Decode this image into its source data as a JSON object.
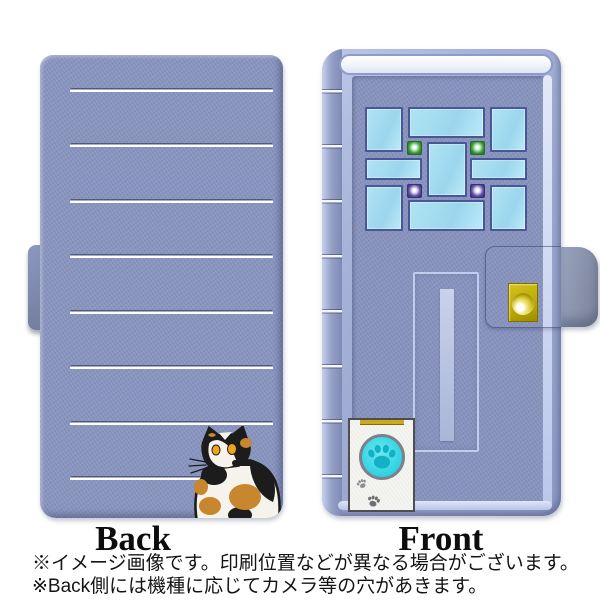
{
  "labels": {
    "back": "Back",
    "front": "Front"
  },
  "footnotes": {
    "line1": "※イメージ画像です。印刷位置などが異なる場合がございます。",
    "line2": "※Back側には機種に応じてカメラ等の穴があきます。"
  },
  "icons": {
    "cat": "calico-cat-illustration",
    "paw_button": "paw-print-button",
    "paw_marks": "paw-prints-decoration",
    "snap": "gold-snap-button"
  },
  "colors": {
    "case_fabric": "#8793bd",
    "case_rim_highlight": "#c6d1ee",
    "stripe_white": "#ffffff",
    "window_pane": "#a8dff2",
    "window_frame": "#4a5797",
    "led_green": "#3c9a3c",
    "led_purple": "#5d4f9e",
    "snap_gold": "#c6b40a",
    "pet_door_white": "#f4f4f1",
    "paw_cyan": "#2fd2e2",
    "paw_print_teal": "#12b1c5",
    "cat_black": "#1c1c1c",
    "cat_white": "#f6f3ec",
    "cat_orange": "#c8862f",
    "text": "#141414"
  }
}
